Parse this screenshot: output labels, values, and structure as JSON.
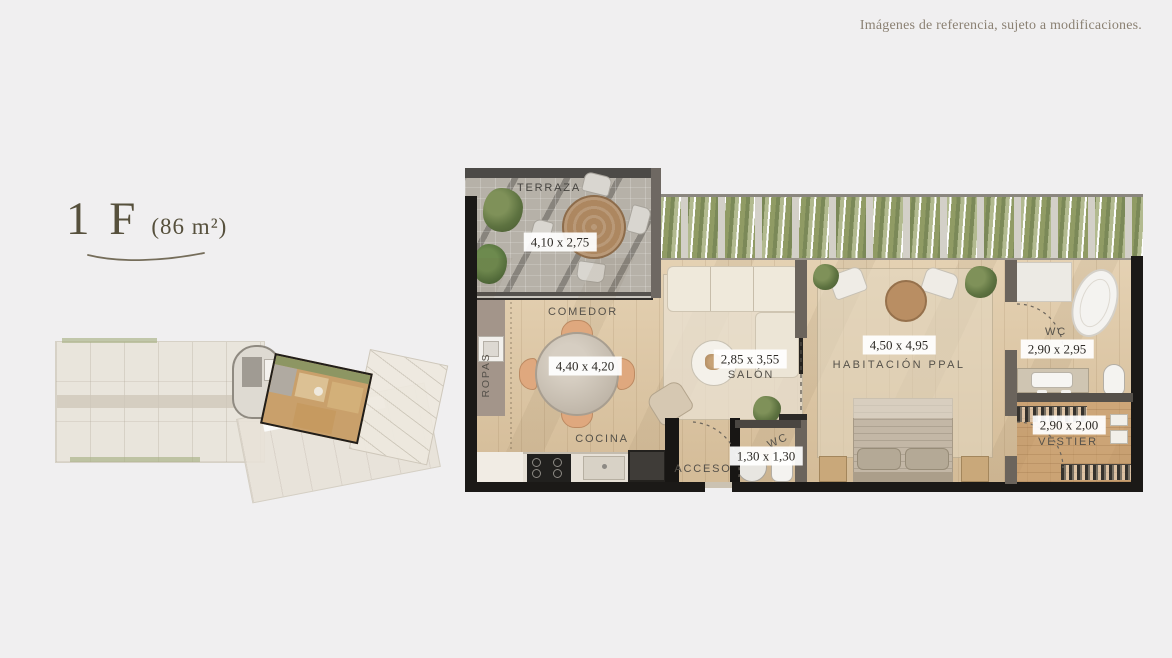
{
  "page": {
    "disclaimer": "Imágenes de referencia, sujeto a modificaciones."
  },
  "unit": {
    "name": "1 F",
    "area": "(86 m²)"
  },
  "plan": {
    "rooms": {
      "terraza": {
        "name": "TERRAZA",
        "dim": "4,10 x 2,75"
      },
      "comedor": {
        "name": "COMEDOR",
        "dim": "4,40 x 4,20"
      },
      "ropas": {
        "name": "ROPAS"
      },
      "cocina": {
        "name": "COCINA"
      },
      "salon": {
        "name": "SALÓN",
        "dim": "2,85 x 3,55"
      },
      "acceso": {
        "name": "ACCESO"
      },
      "wc_acceso": {
        "name": "WC",
        "dim": "1,30 x 1,30"
      },
      "habitacion": {
        "name": "HABITACIÓN PPAL",
        "dim": "4,50 x 4,95"
      },
      "wc_ppal": {
        "name": "WC",
        "dim": "2,90 x 2,95"
      },
      "vestier": {
        "name": "VESTIER",
        "dim": "2,90 x 2,00"
      }
    }
  },
  "colors": {
    "background": "#f0eff0",
    "title_text": "#56503c",
    "disclaimer_text": "#8b8173",
    "wood_floor": "#dcc6a4",
    "greenery": "#8d9663",
    "wall_dark": "#1b1917",
    "keyplan_highlight_outline": "#211e1a"
  }
}
